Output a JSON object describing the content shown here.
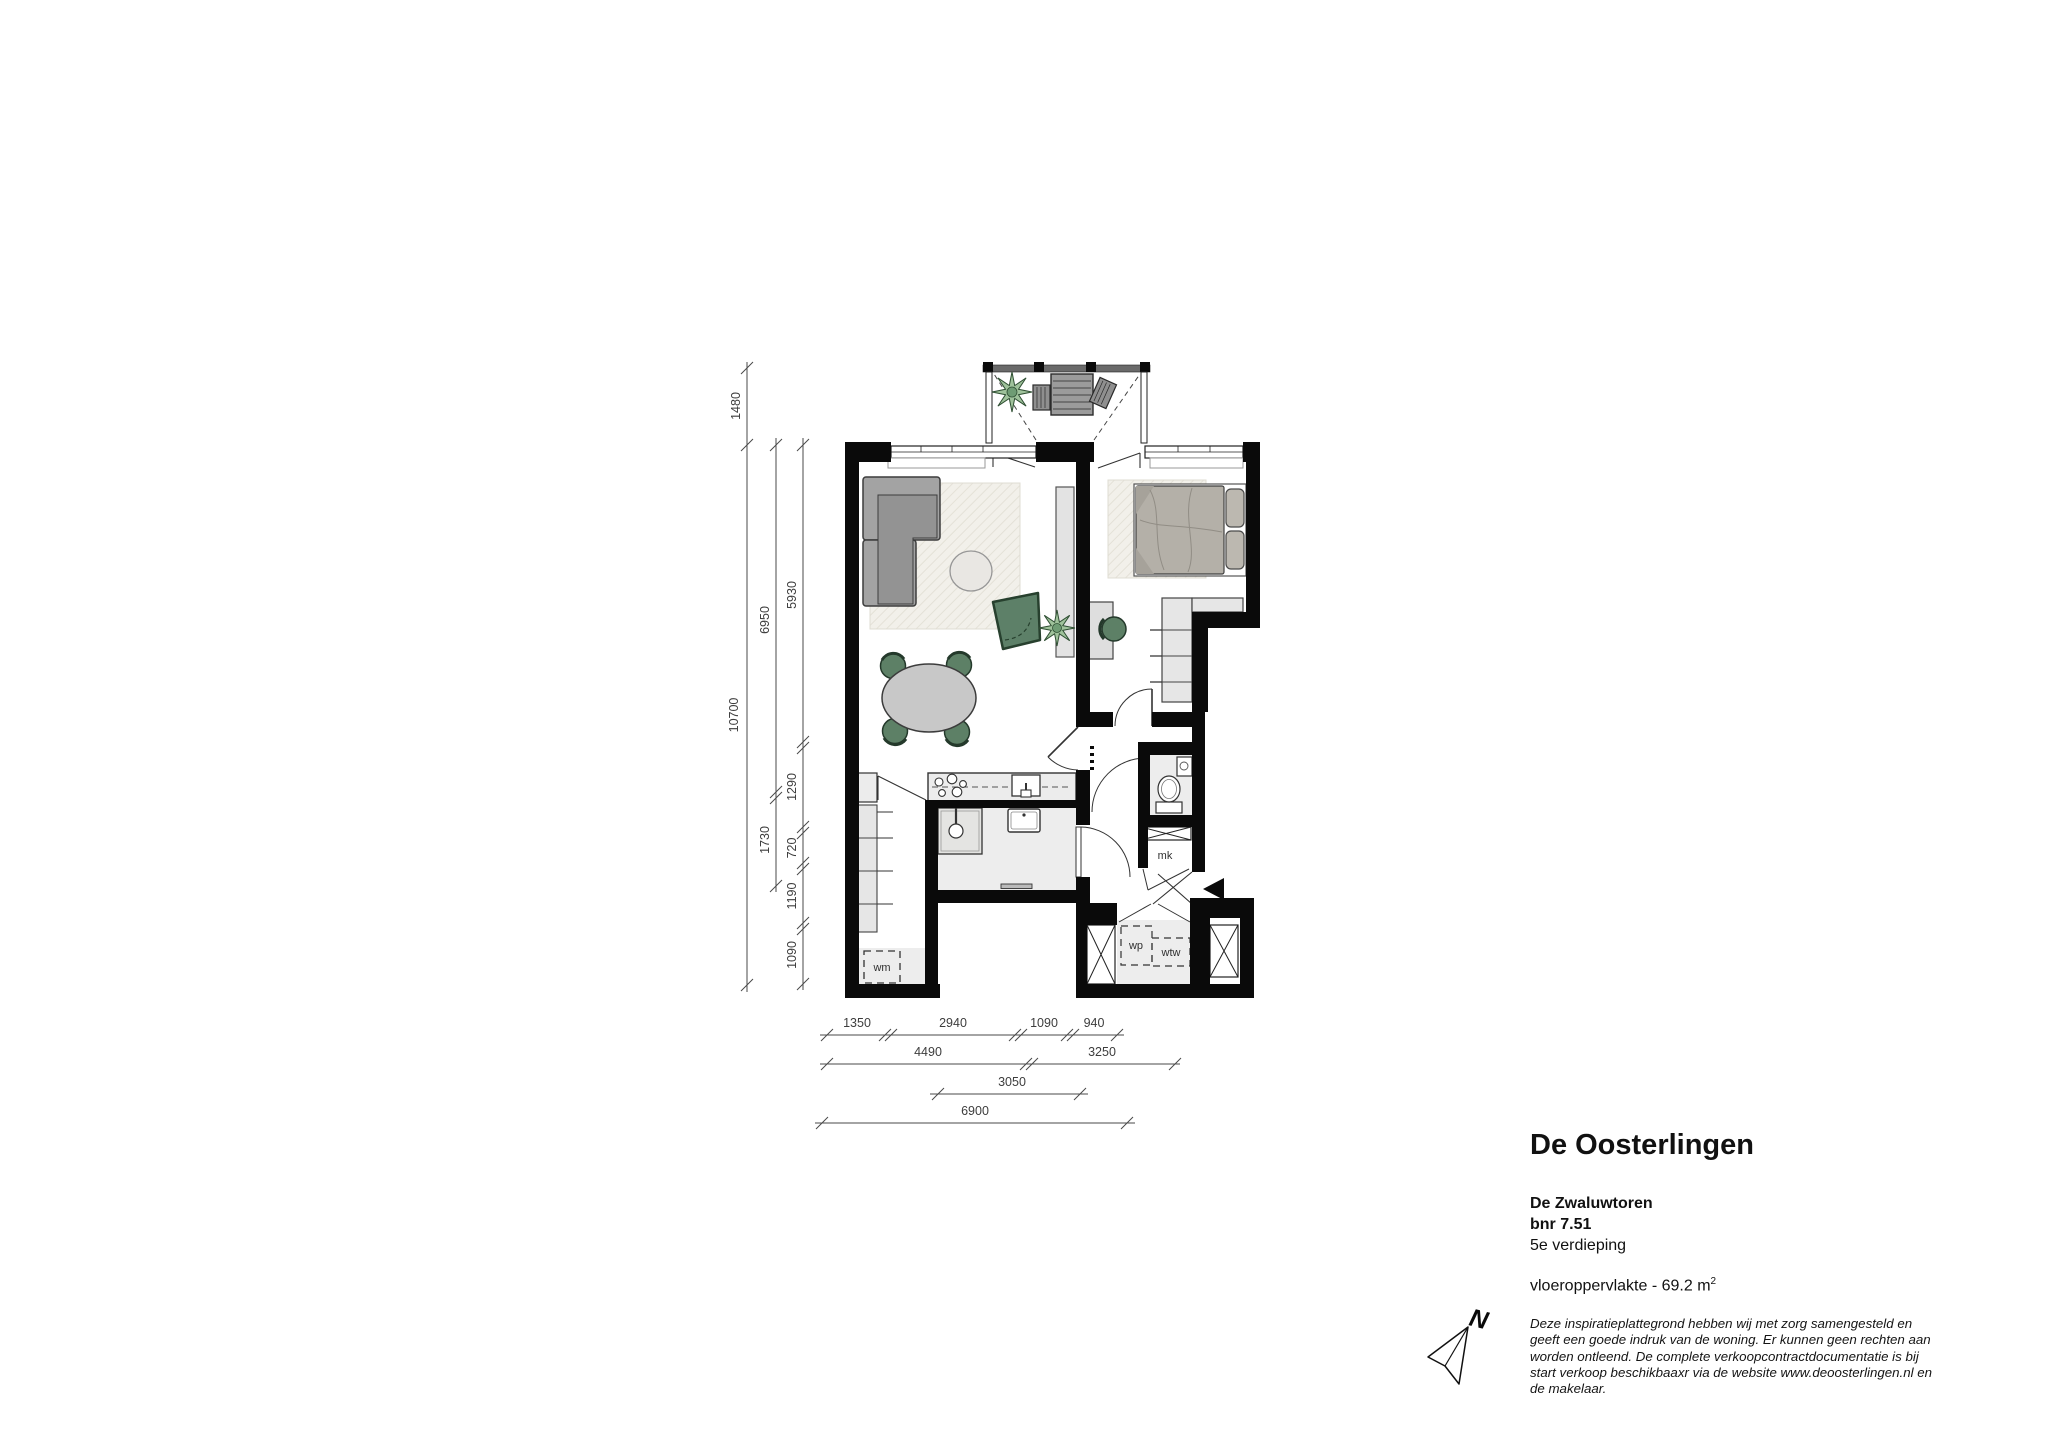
{
  "info": {
    "title": "De Oosterlingen",
    "building": "De Zwaluwtoren",
    "unit": "bnr 7.51",
    "floor": "5e verdieping",
    "area_text": "vloeroppervlakte - 69.2 m",
    "area_sup": "2",
    "disclaimer_lines": [
      "Deze inspiratieplattegrond hebben wij met zorg samengesteld en",
      "geeft een goede indruk van de woning. Er kunnen geen rechten aan",
      "worden ontleend. De complete verkoopcontractdocumentatie is bij",
      "start verkoop beschikbaaxr via de website www.deoosterlingen.nl en",
      "de makelaar."
    ]
  },
  "plan": {
    "labels": {
      "wm": "wm",
      "mk": "mk",
      "wp": "wp",
      "wtw": "wtw"
    },
    "compass_n": "N",
    "dims": {
      "v_outer": [
        "1480",
        "10700"
      ],
      "v_mid": [
        "6950",
        "1730"
      ],
      "v_inner": [
        "5930",
        "1290",
        "720",
        "1190",
        "1090"
      ],
      "h_row1": [
        "1350",
        "2940",
        "1090",
        "940"
      ],
      "h_row2": [
        "4490",
        "3250"
      ],
      "h_row3": [
        "3050"
      ],
      "h_row4": [
        "6900"
      ]
    }
  },
  "colors": {
    "wall": "#0a0a0a",
    "floor_light": "#ededed",
    "furniture_gray": "#a3a3a3",
    "accent_green": "#5d8066",
    "rug_beige": "#f2f0ea",
    "dim_line": "#4a4a4a"
  }
}
